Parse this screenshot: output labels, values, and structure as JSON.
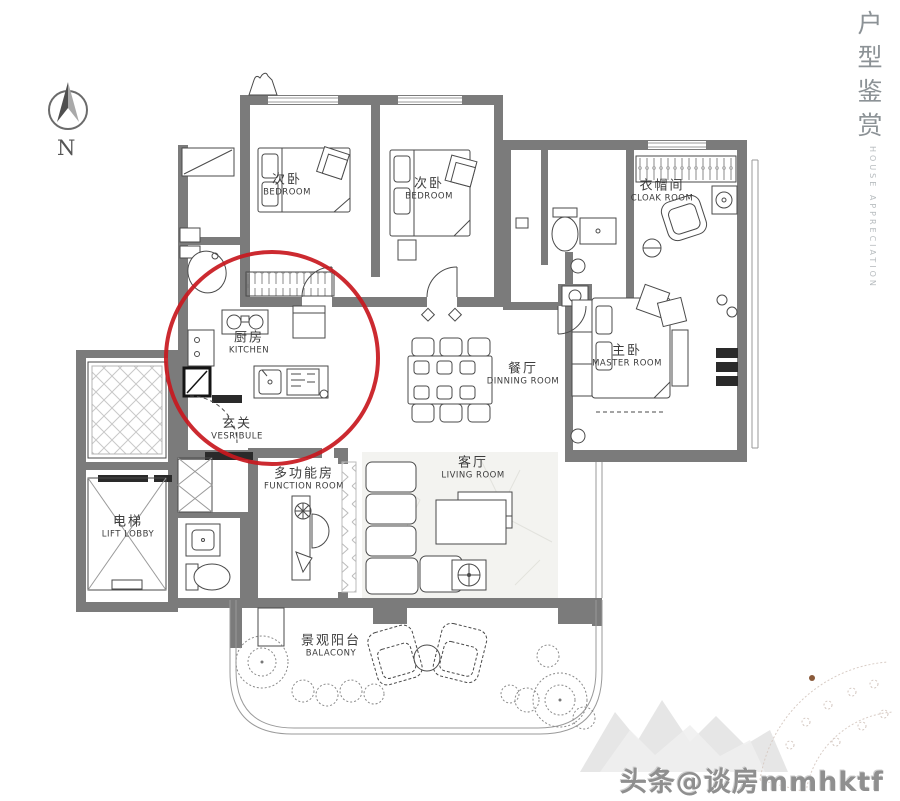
{
  "page": {
    "background": "#ffffff"
  },
  "side_title": {
    "zh": "户型鉴赏",
    "en": "HOUSE APPRECIATION"
  },
  "compass": {
    "label": "N"
  },
  "watermark": {
    "text": "头条@谈房mmhktf"
  },
  "annotation": {
    "shape": "red-circle",
    "color": "#c8181e",
    "highlights": "kitchen and vestibule area"
  },
  "palette": {
    "wall": "#7b7b7b",
    "line": "#4a4a4a",
    "accent_red": "#c8181e"
  },
  "rooms": [
    {
      "id": "bedroom-1",
      "zh": "次卧",
      "en": "BEDROOM"
    },
    {
      "id": "bedroom-2",
      "zh": "次卧",
      "en": "BEDROOM"
    },
    {
      "id": "cloak-room",
      "zh": "衣帽间",
      "en": "CLOAK ROOM"
    },
    {
      "id": "master-room",
      "zh": "主卧",
      "en": "MASTER ROOM"
    },
    {
      "id": "dining-room",
      "zh": "餐厅",
      "en": "DINNING ROOM"
    },
    {
      "id": "kitchen",
      "zh": "厨房",
      "en": "KITCHEN"
    },
    {
      "id": "vestibule",
      "zh": "玄关",
      "en": "VESRIBULE"
    },
    {
      "id": "function-room",
      "zh": "多功能房",
      "en": "FUNCTION ROOM"
    },
    {
      "id": "living-room",
      "zh": "客厅",
      "en": "LIVING ROOM"
    },
    {
      "id": "lift-lobby",
      "zh": "电梯",
      "en": "LIFT LOBBY"
    },
    {
      "id": "balcony",
      "zh": "景观阳台",
      "en": "BALACONY"
    }
  ]
}
